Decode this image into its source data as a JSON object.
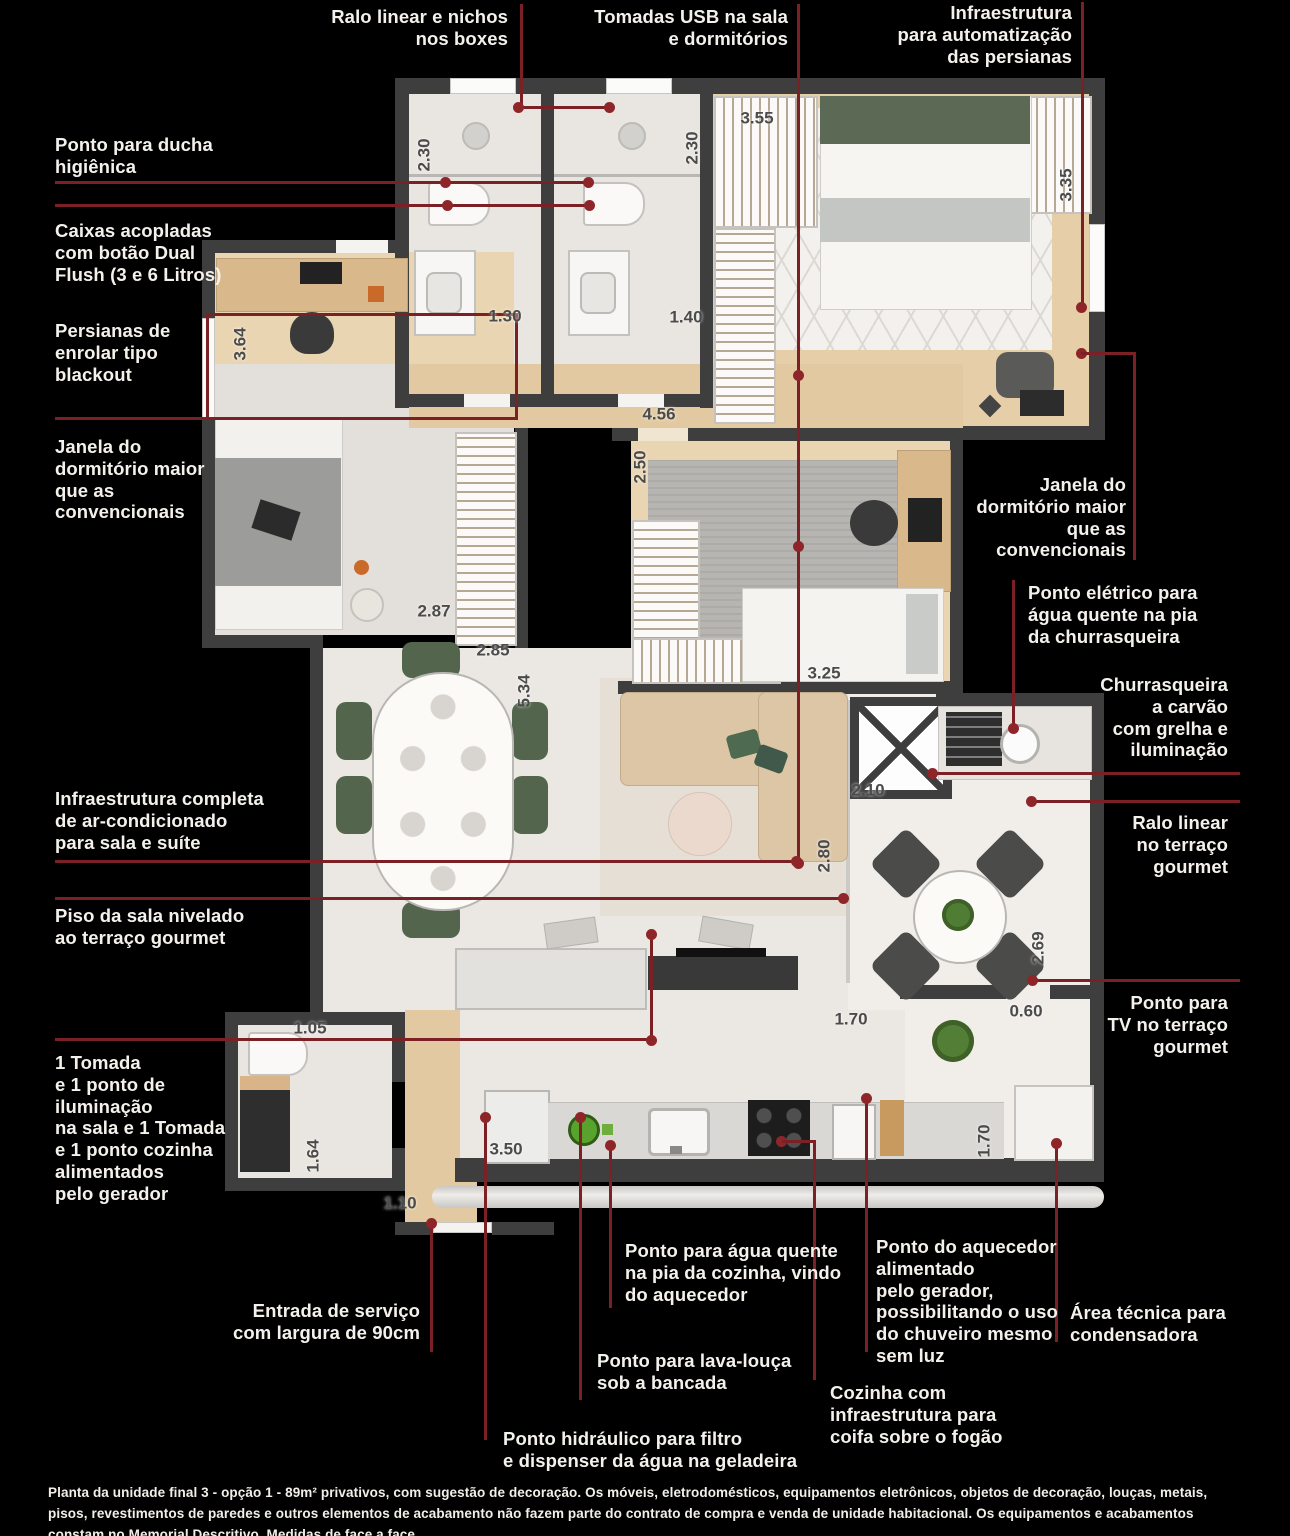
{
  "colors": {
    "background": "#000000",
    "annotation_line": "#7B2125",
    "annotation_dot": "#8E2629",
    "label_text": "#F4F1EC",
    "wall": "#3E3E3E",
    "wood_floor": "#E6CFA8",
    "tile_floor": "#EBE8E3",
    "accent_green_chairs": "#53664D"
  },
  "labels": {
    "ralo_boxes": "Ralo linear e nichos\nnos boxes",
    "tomadas_usb": "Tomadas USB na sala\ne dormitórios",
    "infra_persianas": "Infraestrutura\npara automatização\ndas persianas",
    "ponto_ducha": "Ponto para ducha\nhigiênica",
    "caixas_acopladas": "Caixas acopladas\ncom botão Dual\nFlush (3 e 6 Litros)",
    "persianas_blackout": "Persianas de\nenrolar tipo\nblackout",
    "janela_esquerda": "Janela do\ndormitório maior\nque as\nconvencionais",
    "infra_ar": "Infraestrutura completa\nde ar-condicionado\npara sala e suíte",
    "piso_sala": "Piso da sala nivelado\nao terraço gourmet",
    "tomada_gerador": "1 Tomada\ne 1 ponto de\niluminação\nna sala e 1 Tomada\ne 1 ponto cozinha\nalimentados\npelo gerador",
    "janela_direita": "Janela do\ndormitório maior\nque as\nconvencionais",
    "ponto_eletrico": "Ponto elétrico para\nágua quente na pia\nda churrasqueira",
    "churrasqueira": "Churrasqueira\na carvão\ncom grelha e\niluminação",
    "ralo_terraco": "Ralo linear\nno terraço\ngourmet",
    "ponto_tv": "Ponto para\nTV no terraço\ngourmet",
    "area_tecnica": "Área técnica para\ncondensadora",
    "entrada_servico": "Entrada de serviço\ncom largura de 90cm",
    "agua_quente_cozinha": "Ponto para água quente\nna pia da cozinha, vindo\ndo aquecedor",
    "lava_louca": "Ponto para lava-louça\nsob a bancada",
    "ponto_hidraulico": "Ponto hidráulico para filtro\ne dispenser da água na geladeira",
    "ponto_aquecedor": "Ponto do aquecedor\nalimentado\npelo gerador,\npossibilitando o uso\ndo chuveiro mesmo\nsem luz",
    "cozinha_coifa": "Cozinha com\ninfraestrutura para\ncoifa sobre o fogão"
  },
  "measurements": {
    "bath1_depth": "2.30",
    "bath2_depth": "2.30",
    "bath1_width": "1.30",
    "bath2_width": "1.40",
    "suite_width": "3.55",
    "suite_depth": "3.35",
    "office_depth": "3.64",
    "office_width": "2.87",
    "dining_width": "2.85",
    "living_depth": "5.34",
    "hall_width": "4.56",
    "bedroom2_depth": "2.50",
    "bedroom2_width": "3.25",
    "living_width": "2.80",
    "terrace_top_width": "2.10",
    "terrace_depth": "2.69",
    "terrace_gap": "0.60",
    "kitchen_terrace_width": "1.70",
    "service_bath_width": "1.05",
    "service_bath_depth": "1.64",
    "service_entry_width": "1.10",
    "kitchen_width": "3.50",
    "terrace_bench_width": "1.70"
  },
  "footer": {
    "disclaimer": "Planta da unidade final 3 - opção 1 - 89m² privativos, com sugestão de decoração. Os móveis, eletrodomésticos, equipamentos eletrônicos, objetos de decoração, louças, metais, pisos, revestimentos de paredes e outros elementos de acabamento não fazem parte do contrato de compra e venda de unidade habitacional. Os equipamentos e acabamentos constam no Memorial Descritivo. Medidas de face a face."
  }
}
